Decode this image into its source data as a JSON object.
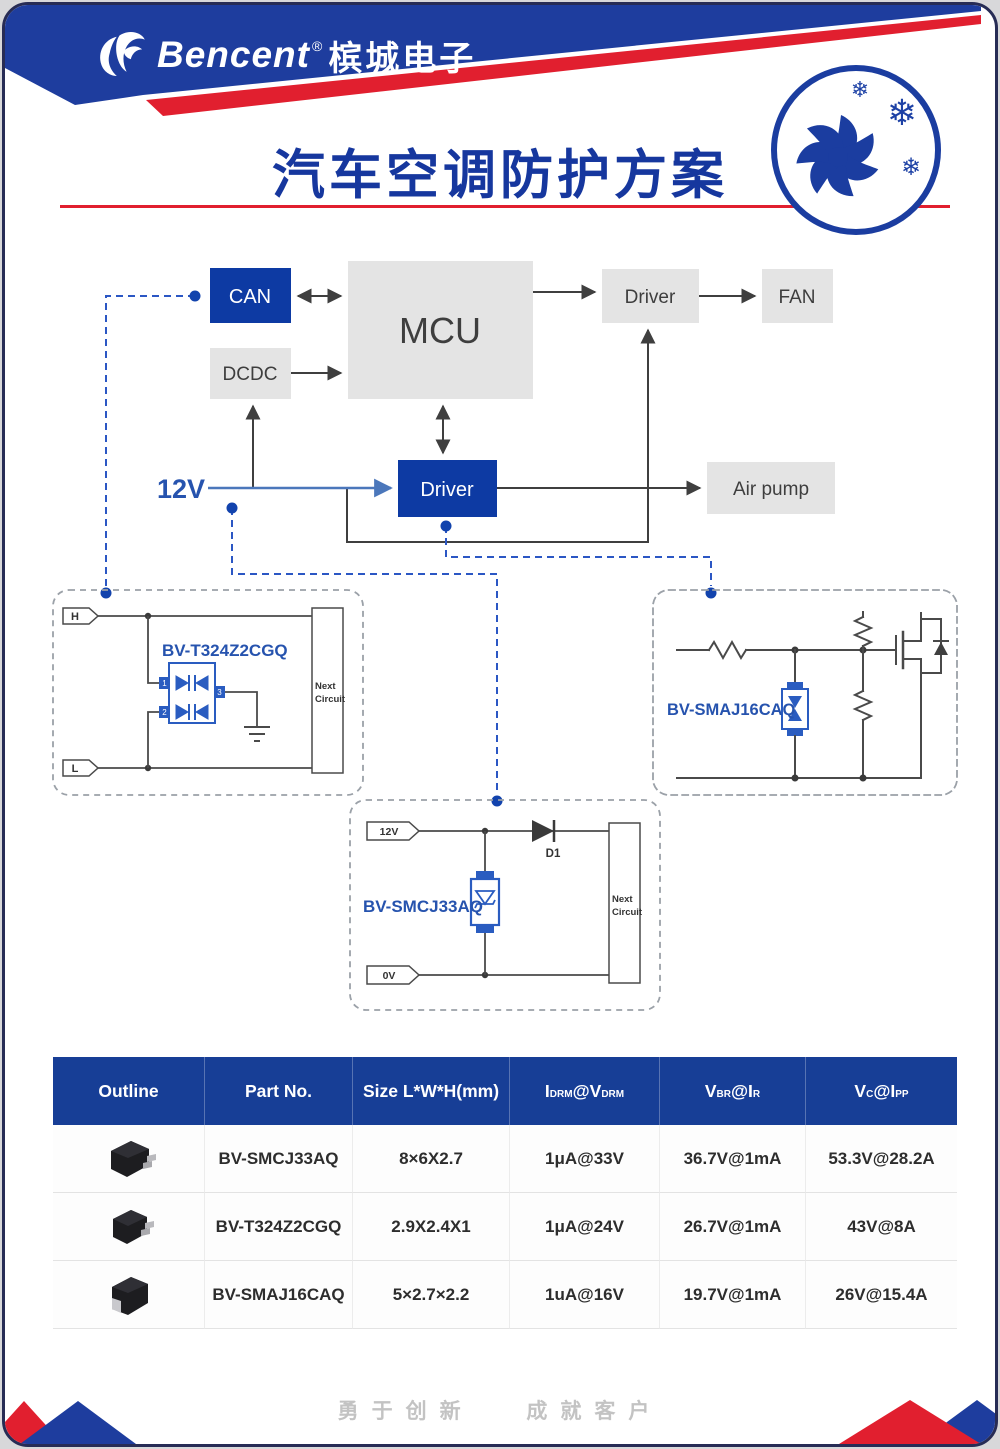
{
  "header": {
    "brand": "Bencent",
    "reg": "®",
    "brand_cn": "槟城电子",
    "title": "汽车空调防护方案"
  },
  "icons": {
    "snowflake": "❄"
  },
  "diagram": {
    "can": "CAN",
    "mcu": "MCU",
    "dcdc": "DCDC",
    "driver_top": "Driver",
    "fan": "FAN",
    "driver_main": "Driver",
    "air_pump": "Air pump",
    "v12": "12V"
  },
  "circuits": {
    "left": {
      "label": "BV-T324Z2CGQ",
      "tag_top": "H",
      "tag_bottom": "L",
      "pins": [
        "1",
        "2",
        "3"
      ],
      "next": [
        "Next",
        "Circuit"
      ]
    },
    "right": {
      "label": "BV-SMAJ16CAQ"
    },
    "bottom": {
      "label": "BV-SMCJ33AQ",
      "tag_top": "12V",
      "tag_bottom": "0V",
      "diode_label": "D1",
      "next": [
        "Next",
        "Circuit"
      ]
    }
  },
  "table": {
    "headers": [
      {
        "text": "Outline"
      },
      {
        "text": "Part No."
      },
      {
        "text": "Size L*W*H(mm)"
      },
      {
        "base": "I",
        "sub": "DRM",
        "base2": "@V",
        "sub2": "DRM"
      },
      {
        "base": "V",
        "sub": "BR",
        "base2": "@I",
        "sub2": "R"
      },
      {
        "base": "V",
        "sub": "C",
        "base2": "@I",
        "sub2": "PP"
      }
    ],
    "rows": [
      {
        "part": "BV-SMCJ33AQ",
        "size": "8×6X2.7",
        "idrm": "1μA@33V",
        "vbr": "36.7V@1mA",
        "vc": "53.3V@28.2A"
      },
      {
        "part": "BV-T324Z2CGQ",
        "size": "2.9X2.4X1",
        "idrm": "1μA@24V",
        "vbr": "26.7V@1mA",
        "vc": "43V@8A"
      },
      {
        "part": "BV-SMAJ16CAQ",
        "size": "5×2.7×2.2",
        "idrm": "1uA@16V",
        "vbr": "19.7V@1mA",
        "vc": "26V@15.4A"
      }
    ]
  },
  "footer": {
    "slogan_left": "勇于创新",
    "slogan_right": "成就客户"
  },
  "colors": {
    "brand_blue": "#16379e",
    "box_blue": "#0d3aa3",
    "red": "#e11f2f",
    "grey_box": "#e4e4e4",
    "circuit_blue": "#2a5cc0",
    "dash_blue": "#2b57c4",
    "table_header_blue": "#173e96"
  }
}
